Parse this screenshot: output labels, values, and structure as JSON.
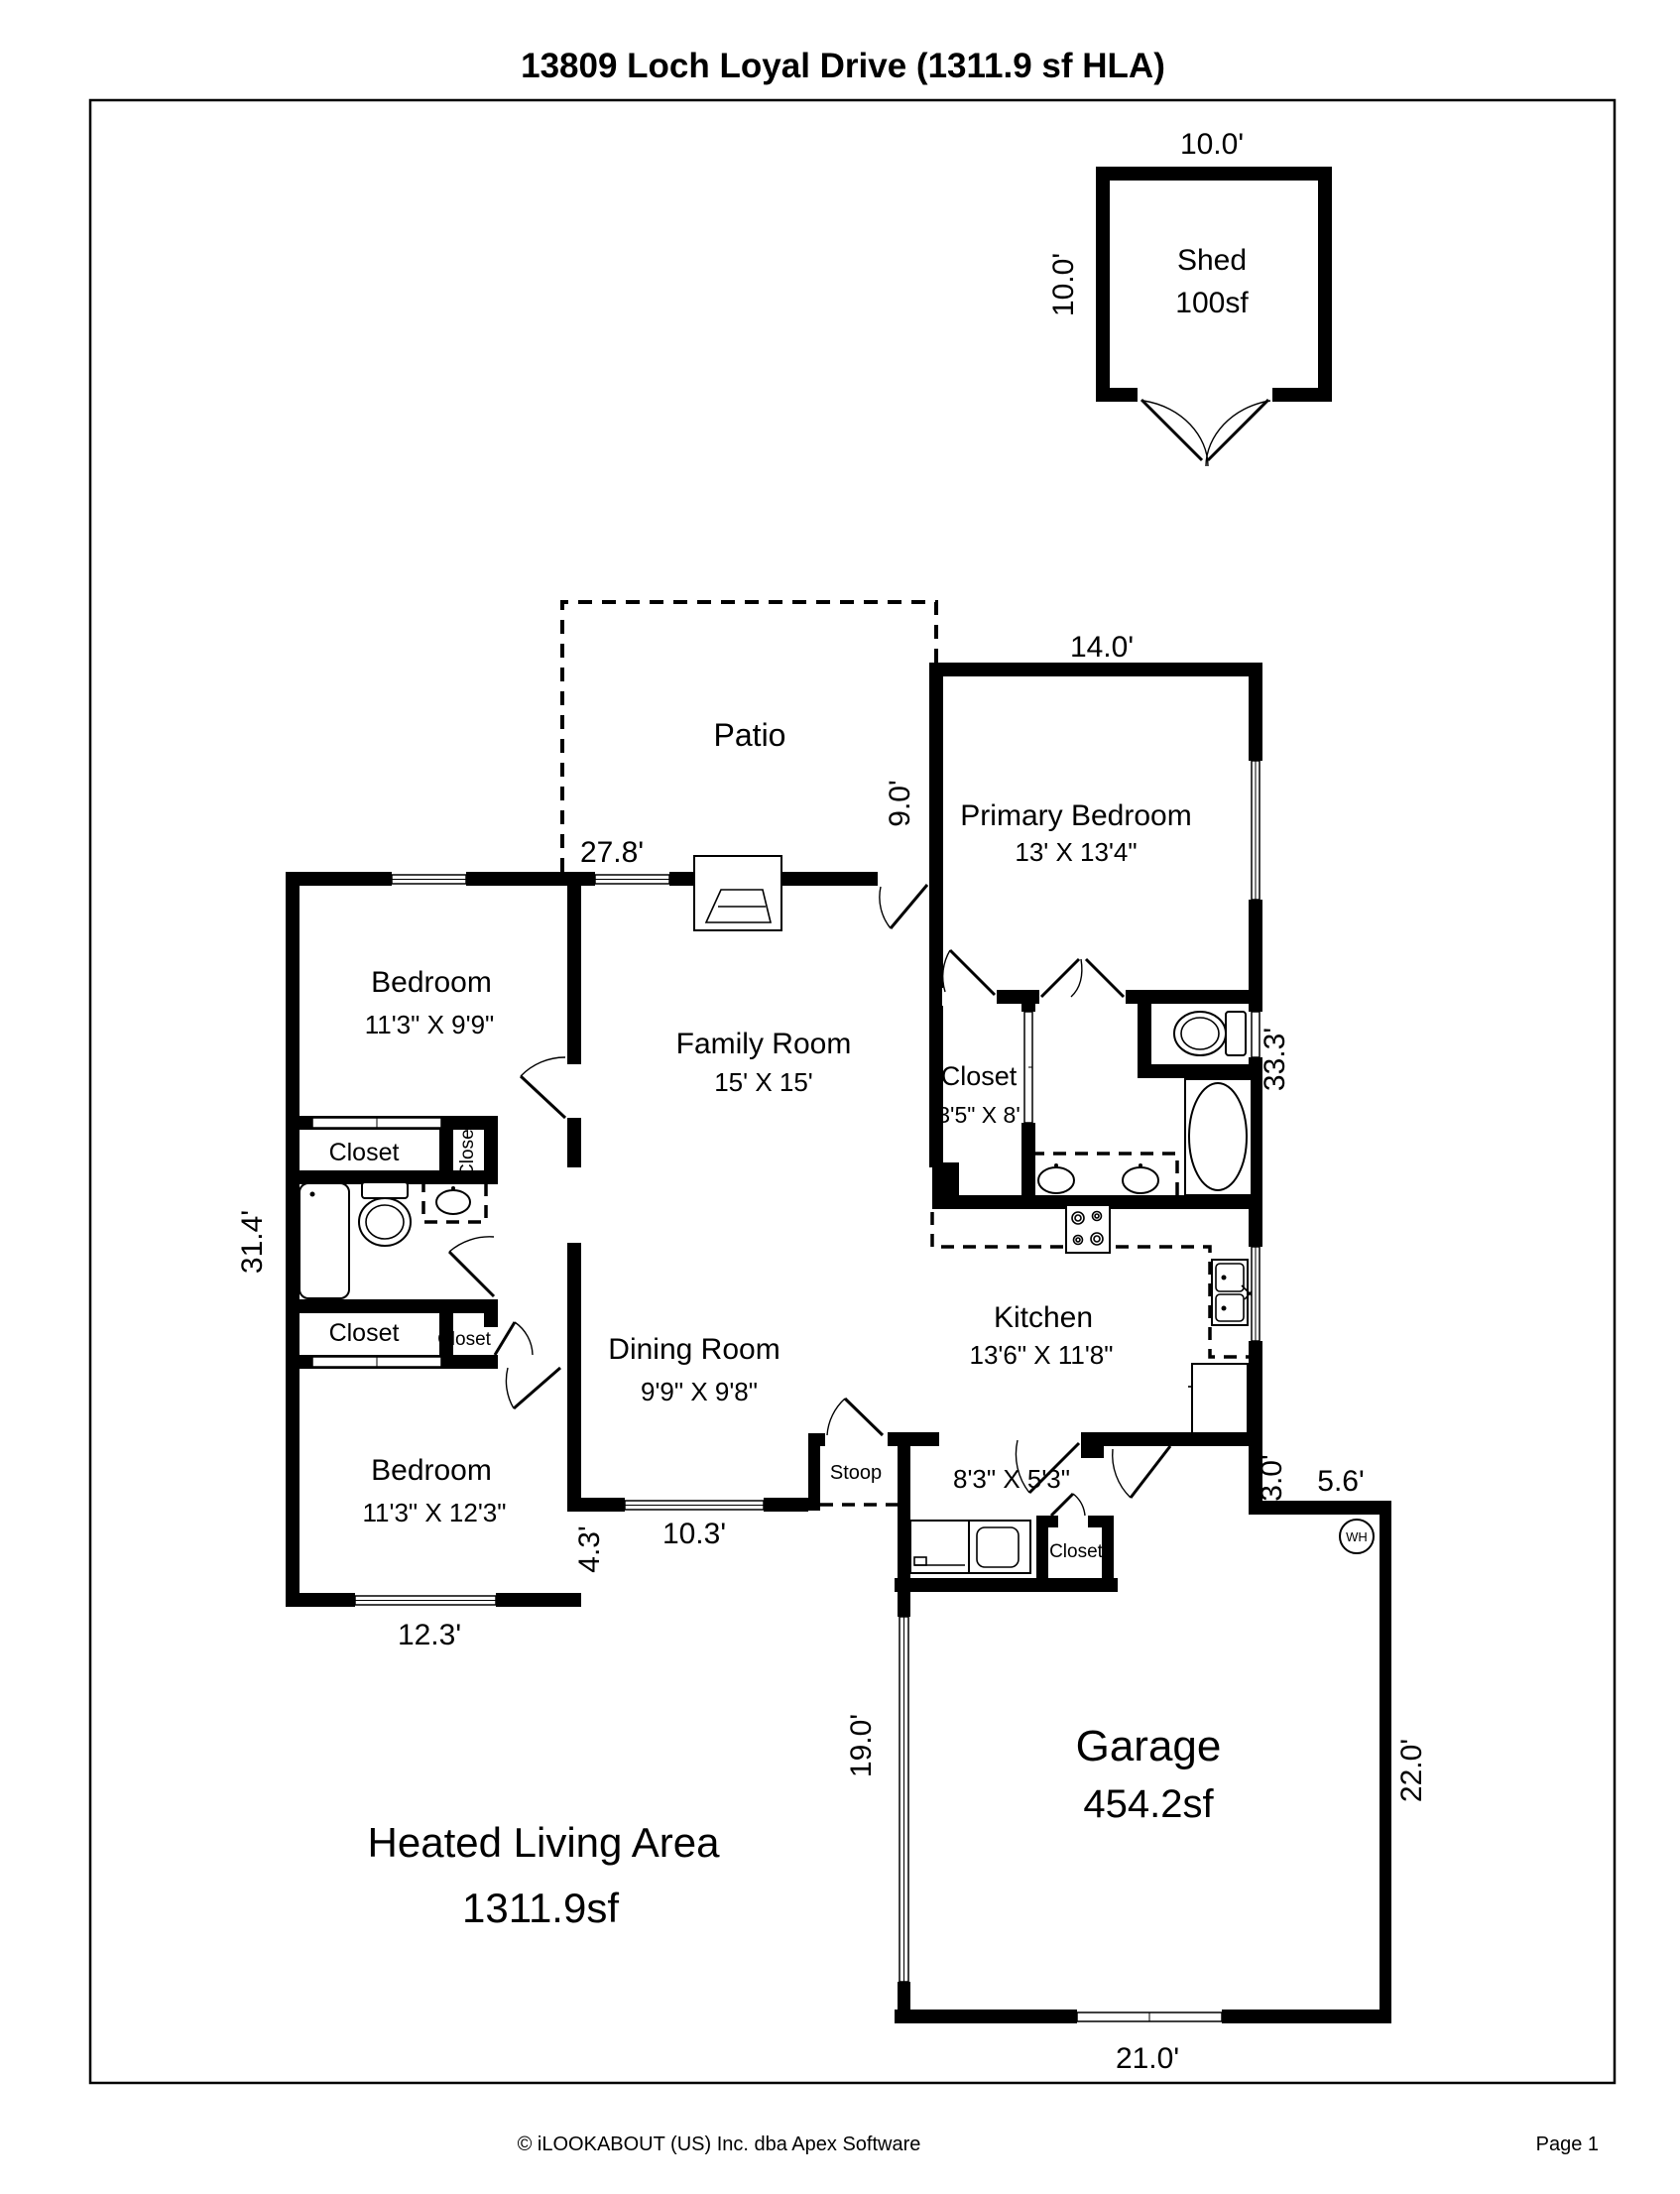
{
  "title": "13809 Loch Loyal Drive (1311.9 sf HLA)",
  "shed": {
    "name": "Shed",
    "area": "100sf",
    "dim_width": "10.0'",
    "dim_height": "10.0'"
  },
  "patio": {
    "name": "Patio"
  },
  "rooms": {
    "primary_bedroom": {
      "name": "Primary Bedroom",
      "size": "13' X 13'4\""
    },
    "family_room": {
      "name": "Family Room",
      "size": "15' X 15'"
    },
    "bedroom_top": {
      "name": "Bedroom",
      "size": "11'3\" X 9'9\""
    },
    "bedroom_bottom": {
      "name": "Bedroom",
      "size": "11'3\" X 12'3\""
    },
    "dining_room": {
      "name": "Dining Room",
      "size": "9'9\" X 9'8\""
    },
    "kitchen": {
      "name": "Kitchen",
      "size": "13'6\" X 11'8\""
    },
    "laundry": {
      "size": "8'3\" X 5'3\""
    },
    "garage": {
      "name": "Garage",
      "area": "454.2sf"
    },
    "walkin_closet": {
      "name": "Closet",
      "size": "3'5\" X 8'"
    },
    "stoop": {
      "name": "Stoop"
    }
  },
  "labels": {
    "closet": "Closet",
    "water_heater": "WH"
  },
  "dimensions": {
    "north_wing": "27.8'",
    "patio_depth": "9.0'",
    "primary_width": "14.0'",
    "right_side": "33.3'",
    "left_side": "31.4'",
    "bedroom_bottom_width": "12.3'",
    "step": "4.3'",
    "dining_width": "10.3'",
    "kitchen_step": "3.0'",
    "garage_step": "5.6'",
    "garage_left": "19.0'",
    "garage_width": "21.0'",
    "garage_right": "22.0'"
  },
  "hla": {
    "line1": "Heated Living Area",
    "line2": "1311.9sf"
  },
  "footer": {
    "copyright": "© iLOOKABOUT (US) Inc. dba Apex Software",
    "page": "Page 1"
  }
}
